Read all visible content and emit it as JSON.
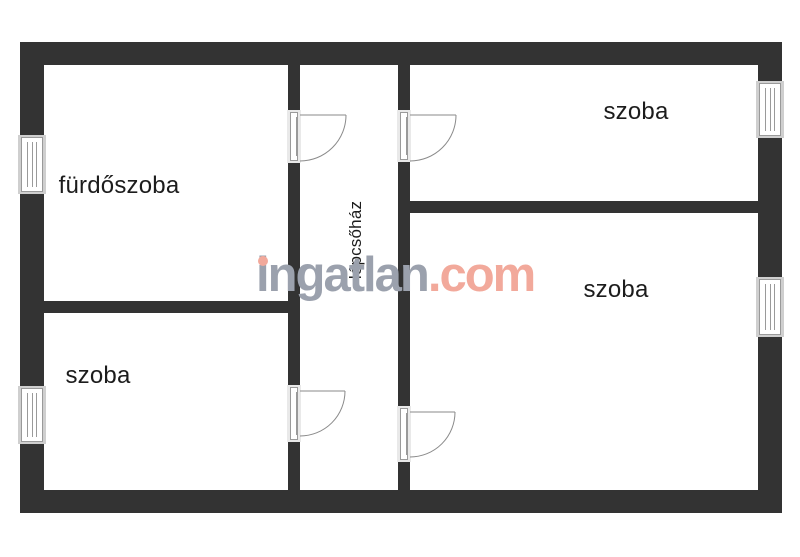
{
  "floorplan": {
    "rooms": [
      {
        "id": "bathroom",
        "label": "fürdőszoba"
      },
      {
        "id": "room-bottom-left",
        "label": "szoba"
      },
      {
        "id": "room-top-right",
        "label": "szoba"
      },
      {
        "id": "room-bottom-right",
        "label": "szoba"
      },
      {
        "id": "staircase",
        "label": "lépcsőház"
      }
    ],
    "watermark": {
      "brand": "ingatlan",
      "suffix": ".com"
    },
    "colors": {
      "wall": "#333333",
      "window_frame": "#cfcfcf",
      "door_line": "#8a8a8a",
      "label": "#1c1c1c",
      "wm_brand": "#9ba1ad",
      "wm_accent": "#f2a99b"
    }
  }
}
